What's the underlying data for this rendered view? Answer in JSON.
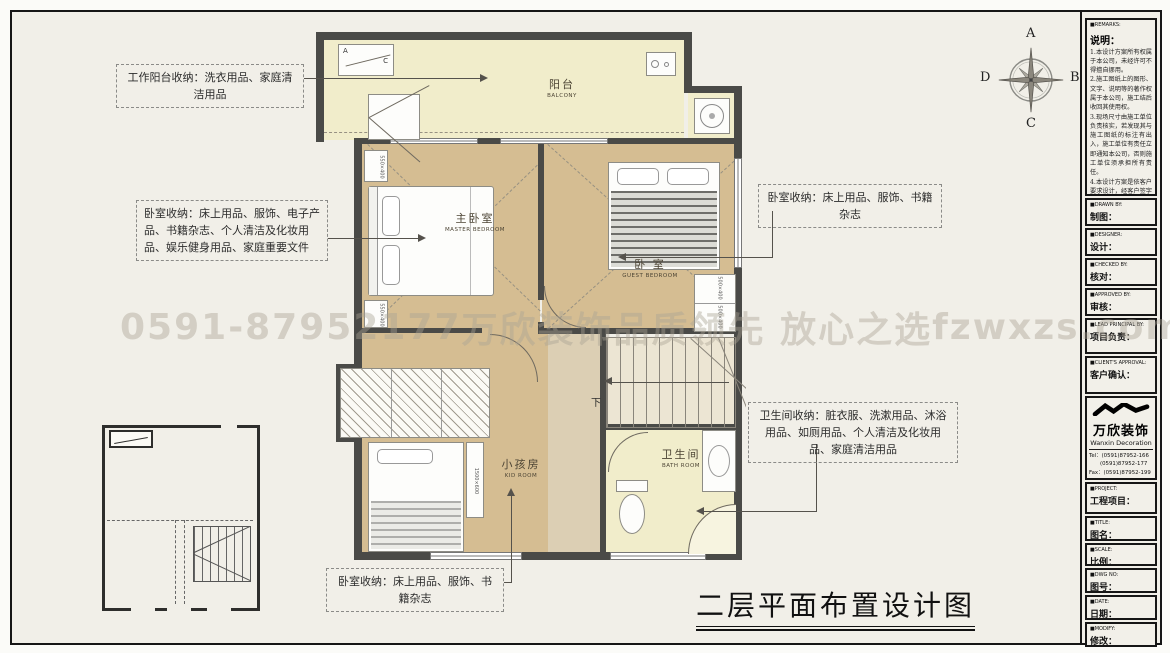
{
  "watermark": {
    "phone": "0591-87952177",
    "brand": "万欣装饰",
    "slogan": "品质领先 放心之选",
    "site": "fzwxzs.com"
  },
  "compass": {
    "a": "A",
    "b": "B",
    "c": "C",
    "d": "D"
  },
  "drawing_title": "二层平面布置设计图",
  "callouts": {
    "balcony": "工作阳台收纳：洗衣用品、家庭清洁用品",
    "master": "卧室收纳：床上用品、服饰、电子产品、书籍杂志、个人清洁及化妆用品、娱乐健身用品、家庭重要文件",
    "guest": "卧室收纳：床上用品、服饰、书籍杂志",
    "bath": "卫生间收纳：脏衣服、洗漱用品、沐浴用品、如厕用品、个人清洁及化妆用品、家庭清洁用品",
    "kid": "卧室收纳：床上用品、服饰、书籍杂志"
  },
  "rooms": {
    "balcony": {
      "zh": "阳台",
      "en": "BALCONY"
    },
    "master": {
      "zh": "主卧室",
      "en": "MASTER BEDROOM"
    },
    "guest": {
      "zh": "卧 室",
      "en": "GUEST BEDROOM"
    },
    "kid": {
      "zh": "小孩房",
      "en": "KID ROOM"
    },
    "bath": {
      "zh": "卫生间",
      "en": "BATH ROOM"
    }
  },
  "plan": {
    "stair_down": "下",
    "lift_a": "A",
    "lift_c": "C",
    "nightstand_dim": "550×400",
    "cabinet_dim": "500×400",
    "desk_dim": "1500×600"
  },
  "sidebar": {
    "remarks": {
      "tag": "■REMARKS:",
      "heading": "说明：",
      "notes": [
        "1.本设计方案所有权属于本公司，未经许可不得擅自挪用。",
        "2.施工图纸上的图形、文字、说明等的著作权属于本公司，施工结后收回其使用权。",
        "3.现场尺寸由施工单位负责核实，若发现其与施工图纸的标注有出入，施工单位有责任立即通知本公司，否则施工单位须承担所有责任。",
        "4.本设计方案是依客户要求设计，经客户签字确认为同意认可，不得随意更改。"
      ]
    },
    "fields": [
      {
        "tag": "■DRAWN BY:",
        "label": "制图："
      },
      {
        "tag": "■DESIGNER:",
        "label": "设计："
      },
      {
        "tag": "■CHECKED BY:",
        "label": "核对："
      },
      {
        "tag": "■APPROVED BY:",
        "label": "审核："
      },
      {
        "tag": "■LEAD PRINCIPAL BY:",
        "label": "项目负责："
      },
      {
        "tag": "■CLIENT'S APPROVAL:",
        "label": "客户确认："
      }
    ],
    "company": {
      "logo_zh": "万欣装饰",
      "logo_en": "Wanxin Decoration",
      "tel1": "Tel：(0591)87952-166",
      "tel2": "(0591)87952-177",
      "fax": "Fax：(0591)87952-199",
      "web": "Web：WWW.fzwxzs.com"
    },
    "fields2": [
      {
        "tag": "■PROJECT:",
        "label": "工程项目："
      },
      {
        "tag": "■TITLE:",
        "label": "图名："
      },
      {
        "tag": "■SCALE:",
        "label": "比例："
      },
      {
        "tag": "■DWG NO:",
        "label": "图号："
      },
      {
        "tag": "■DATE:",
        "label": "日期："
      },
      {
        "tag": "■MODIFY:",
        "label": "修改："
      }
    ]
  },
  "colors": {
    "floor_tan": "#d5bd92",
    "floor_pale": "#f1edcb",
    "wall": "#4a4a47",
    "frame": "#161616"
  }
}
